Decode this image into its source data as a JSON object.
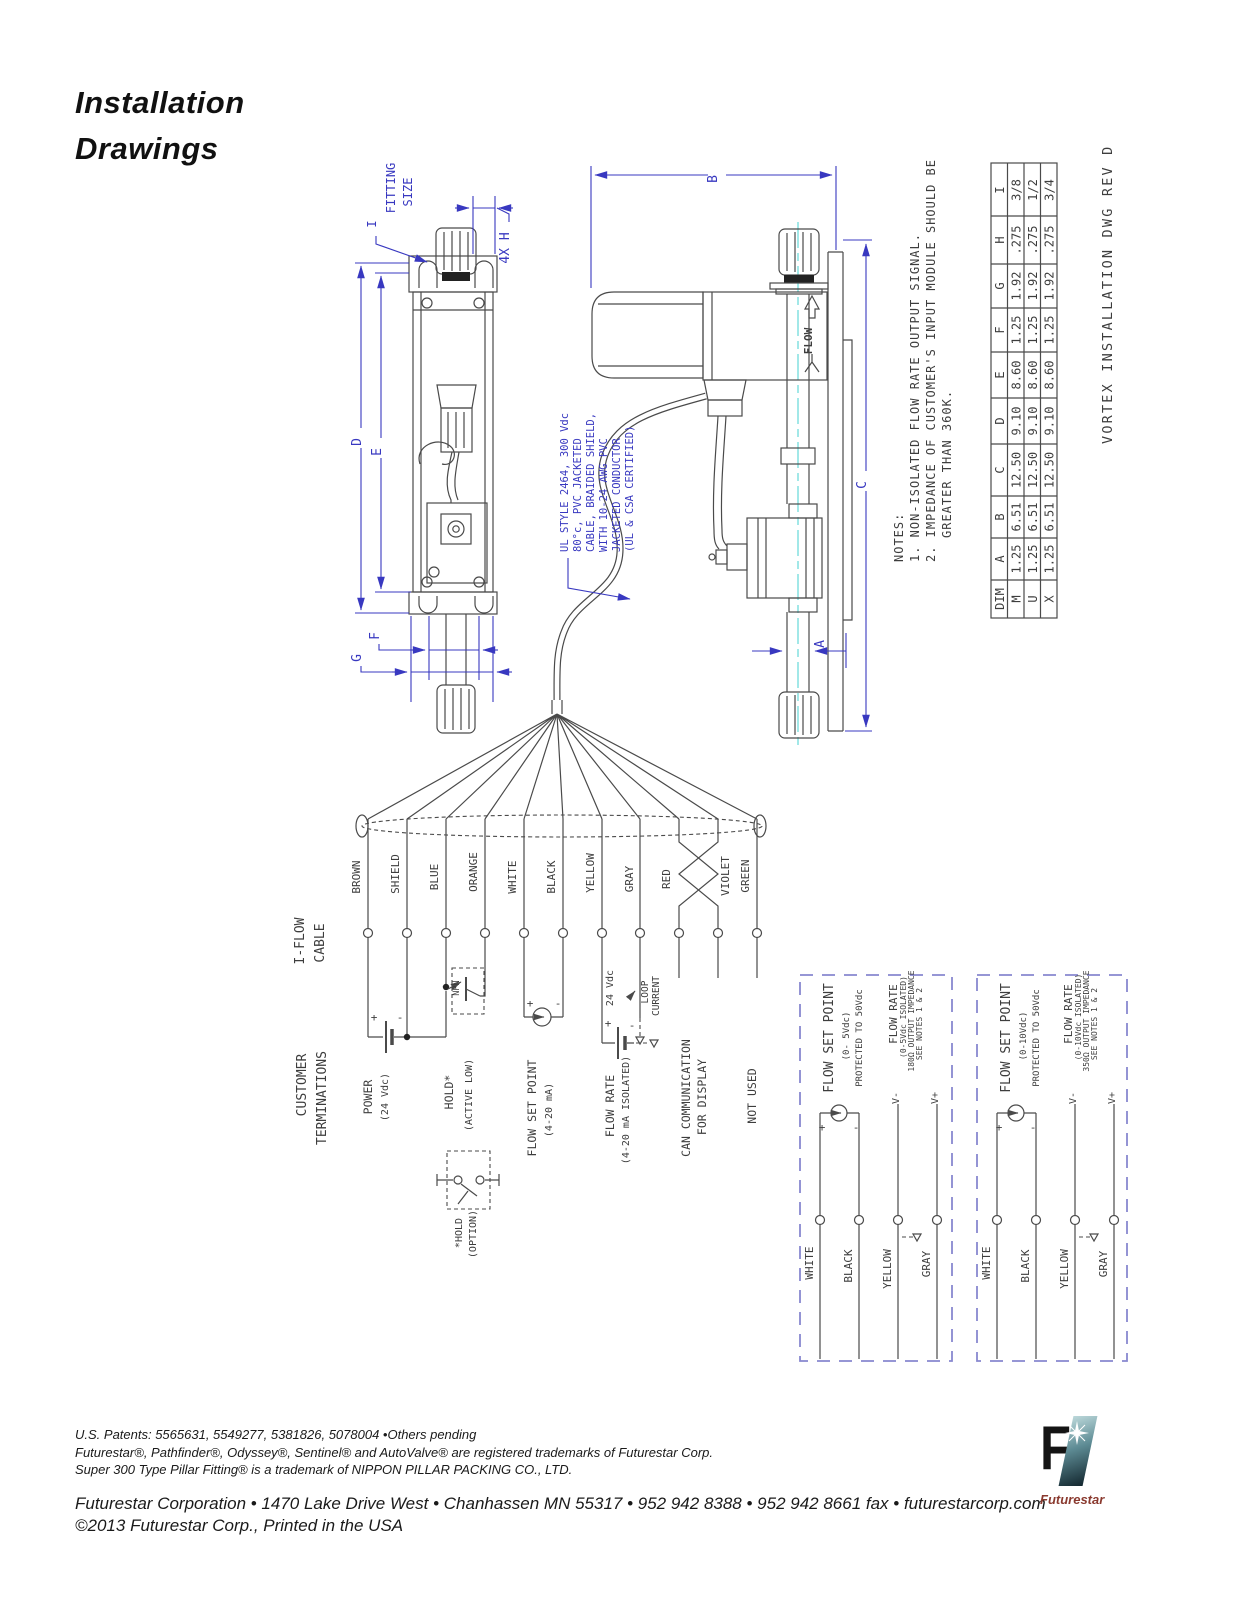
{
  "page": {
    "title": [
      "Installation",
      "Drawings"
    ]
  },
  "drawing": {
    "rev_label": "VORTEX INSTALLATION DWG REV D",
    "flow_label": "FLOW",
    "fitting_note": [
      "I",
      "FITTING",
      "SIZE"
    ],
    "dims": {
      "a": "A",
      "b": "B",
      "c": "C",
      "d": "D",
      "e": "E",
      "f": "F",
      "g": "G",
      "h": "4X H"
    },
    "cable_note": [
      "UL STYLE 2464, 300 Vdc",
      "80°c, PVC JACKETED",
      "CABLE, BRAIDED SHIELD,",
      "WITH 10-24 AWG PVC",
      "JACKETED CONDUCTOR",
      "(UL & CSA CERTIFIED)"
    ],
    "notes": [
      "NOTES:",
      "1. NON-ISOLATED FLOW RATE OUTPUT SIGNAL.",
      "2. IMPEDANCE OF CUSTOMER'S INPUT MODULE SHOULD BE",
      "GREATER THAN 360K."
    ]
  },
  "table": {
    "headers": [
      "DIM",
      "A",
      "B",
      "C",
      "D",
      "E",
      "F",
      "G",
      "H",
      "I"
    ],
    "rows": [
      [
        "M",
        "1.25",
        "6.51",
        "12.50",
        "9.10",
        "8.60",
        "1.25",
        "1.92",
        ".275",
        "3/8"
      ],
      [
        "U",
        "1.25",
        "6.51",
        "12.50",
        "9.10",
        "8.60",
        "1.25",
        "1.92",
        ".275",
        "1/2"
      ],
      [
        "X",
        "1.25",
        "6.51",
        "12.50",
        "9.10",
        "8.60",
        "1.25",
        "1.92",
        ".275",
        "3/4"
      ]
    ]
  },
  "wiring": {
    "cable_label": [
      "I-FLOW",
      "CABLE"
    ],
    "customer_label": [
      "CUSTOMER",
      "TERMINATIONS"
    ],
    "wires": [
      "BROWN",
      "SHIELD",
      "BLUE",
      "ORANGE",
      "WHITE",
      "BLACK",
      "YELLOW",
      "GRAY",
      "RED",
      "VIOLET",
      "GREEN"
    ],
    "power": [
      "POWER",
      "(24 Vdc)"
    ],
    "hold": [
      "HOLD*",
      "(ACTIVE LOW)"
    ],
    "npn": "NPN",
    "hold_option": [
      "*HOLD",
      "(OPTION)"
    ],
    "flow_set_point": [
      "FLOW SET POINT",
      "(4-20 mA)"
    ],
    "flow_rate": [
      "FLOW RATE",
      "(4-20 mA ISOLATED)"
    ],
    "vdc": "24 Vdc",
    "plus": "+",
    "minus": "-",
    "loop": [
      "LOOP",
      "CURRENT"
    ],
    "can": [
      "CAN COMMUNICATION",
      "FOR DISPLAY"
    ],
    "not_used": "NOT USED"
  },
  "termination_boxes": [
    {
      "title": "FLOW SET POINT",
      "range": "(0- 5Vdc)",
      "protection": "PROTECTED TO 50Vdc",
      "rate_title": "FLOW RATE",
      "rate_range": "(0-5Vdc ISOLATED)",
      "impedance": "180Ω OUTPUT IMPEDANCE",
      "see_notes": "SEE NOTES 1 & 2",
      "v_minus": "V-",
      "v_plus": "V+",
      "wires": [
        "WHITE",
        "BLACK",
        "YELLOW",
        "GRAY"
      ]
    },
    {
      "title": "FLOW SET POINT",
      "range": "(0-10Vdc)",
      "protection": "PROTECTED TO 50Vdc",
      "rate_title": "FLOW RATE",
      "rate_range": "(0-10Vdc ISOLATED)",
      "impedance": "350Ω OUTPUT IMPEDANCE",
      "see_notes": "SEE NOTES 1 & 2",
      "v_minus": "V-",
      "v_plus": "V+",
      "wires": [
        "WHITE",
        "BLACK",
        "YELLOW",
        "GRAY"
      ]
    }
  ],
  "footer": {
    "patents": "U.S. Patents: 5565631, 5549277, 5381826, 5078004 •Others pending",
    "trademarks1": "Futurestar®, Pathfinder®, Odyssey®, Sentinel® and AutoValve® are registered trademarks of Futurestar Corp.",
    "trademarks2": "Super 300 Type Pillar Fitting® is a trademark of NIPPON PILLAR PACKING CO., LTD.",
    "address": "Futurestar Corporation • 1470 Lake Drive West • Chanhassen MN 55317  • 952 942 8388 • 952 942 8661 fax • futurestarcorp.com",
    "copyright": "©2013 Futurestar Corp., Printed in the USA",
    "brand": "Futurestar"
  },
  "colors": {
    "dimension_blue": "#3838c0",
    "line_gray": "#4a4a4a",
    "centerline_cyan": "#7adede",
    "dashed_purple": "#8888cf"
  }
}
